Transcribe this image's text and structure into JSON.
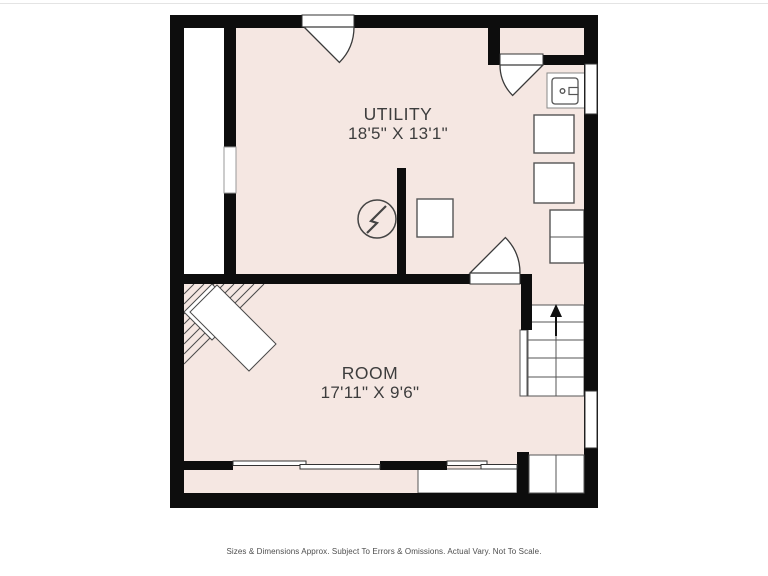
{
  "page": {
    "disclaimer": "Sizes & Dimensions Approx. Subject To Errors & Omissions. Actual Vary. Not To Scale."
  },
  "floorplan": {
    "rooms": [
      {
        "name": "UTILITY",
        "dimensions": "18'5\" X 13'1\""
      },
      {
        "name": "ROOM",
        "dimensions": "17'11\" X 9'6\""
      }
    ],
    "stairs": {
      "direction": "up",
      "symbol": "arrow-up"
    },
    "fixtures": [
      "sink-unit",
      "appliance-square",
      "appliance-square",
      "appliance-square",
      "cabinet-stack",
      "electrical-panel-symbol",
      "corner-winder-stairs"
    ],
    "colors": {
      "floor_fill": "#f5e7e2",
      "wall": "#0d0d0d",
      "fixture_line": "#555555",
      "label_text": "#3d3d3d"
    }
  }
}
